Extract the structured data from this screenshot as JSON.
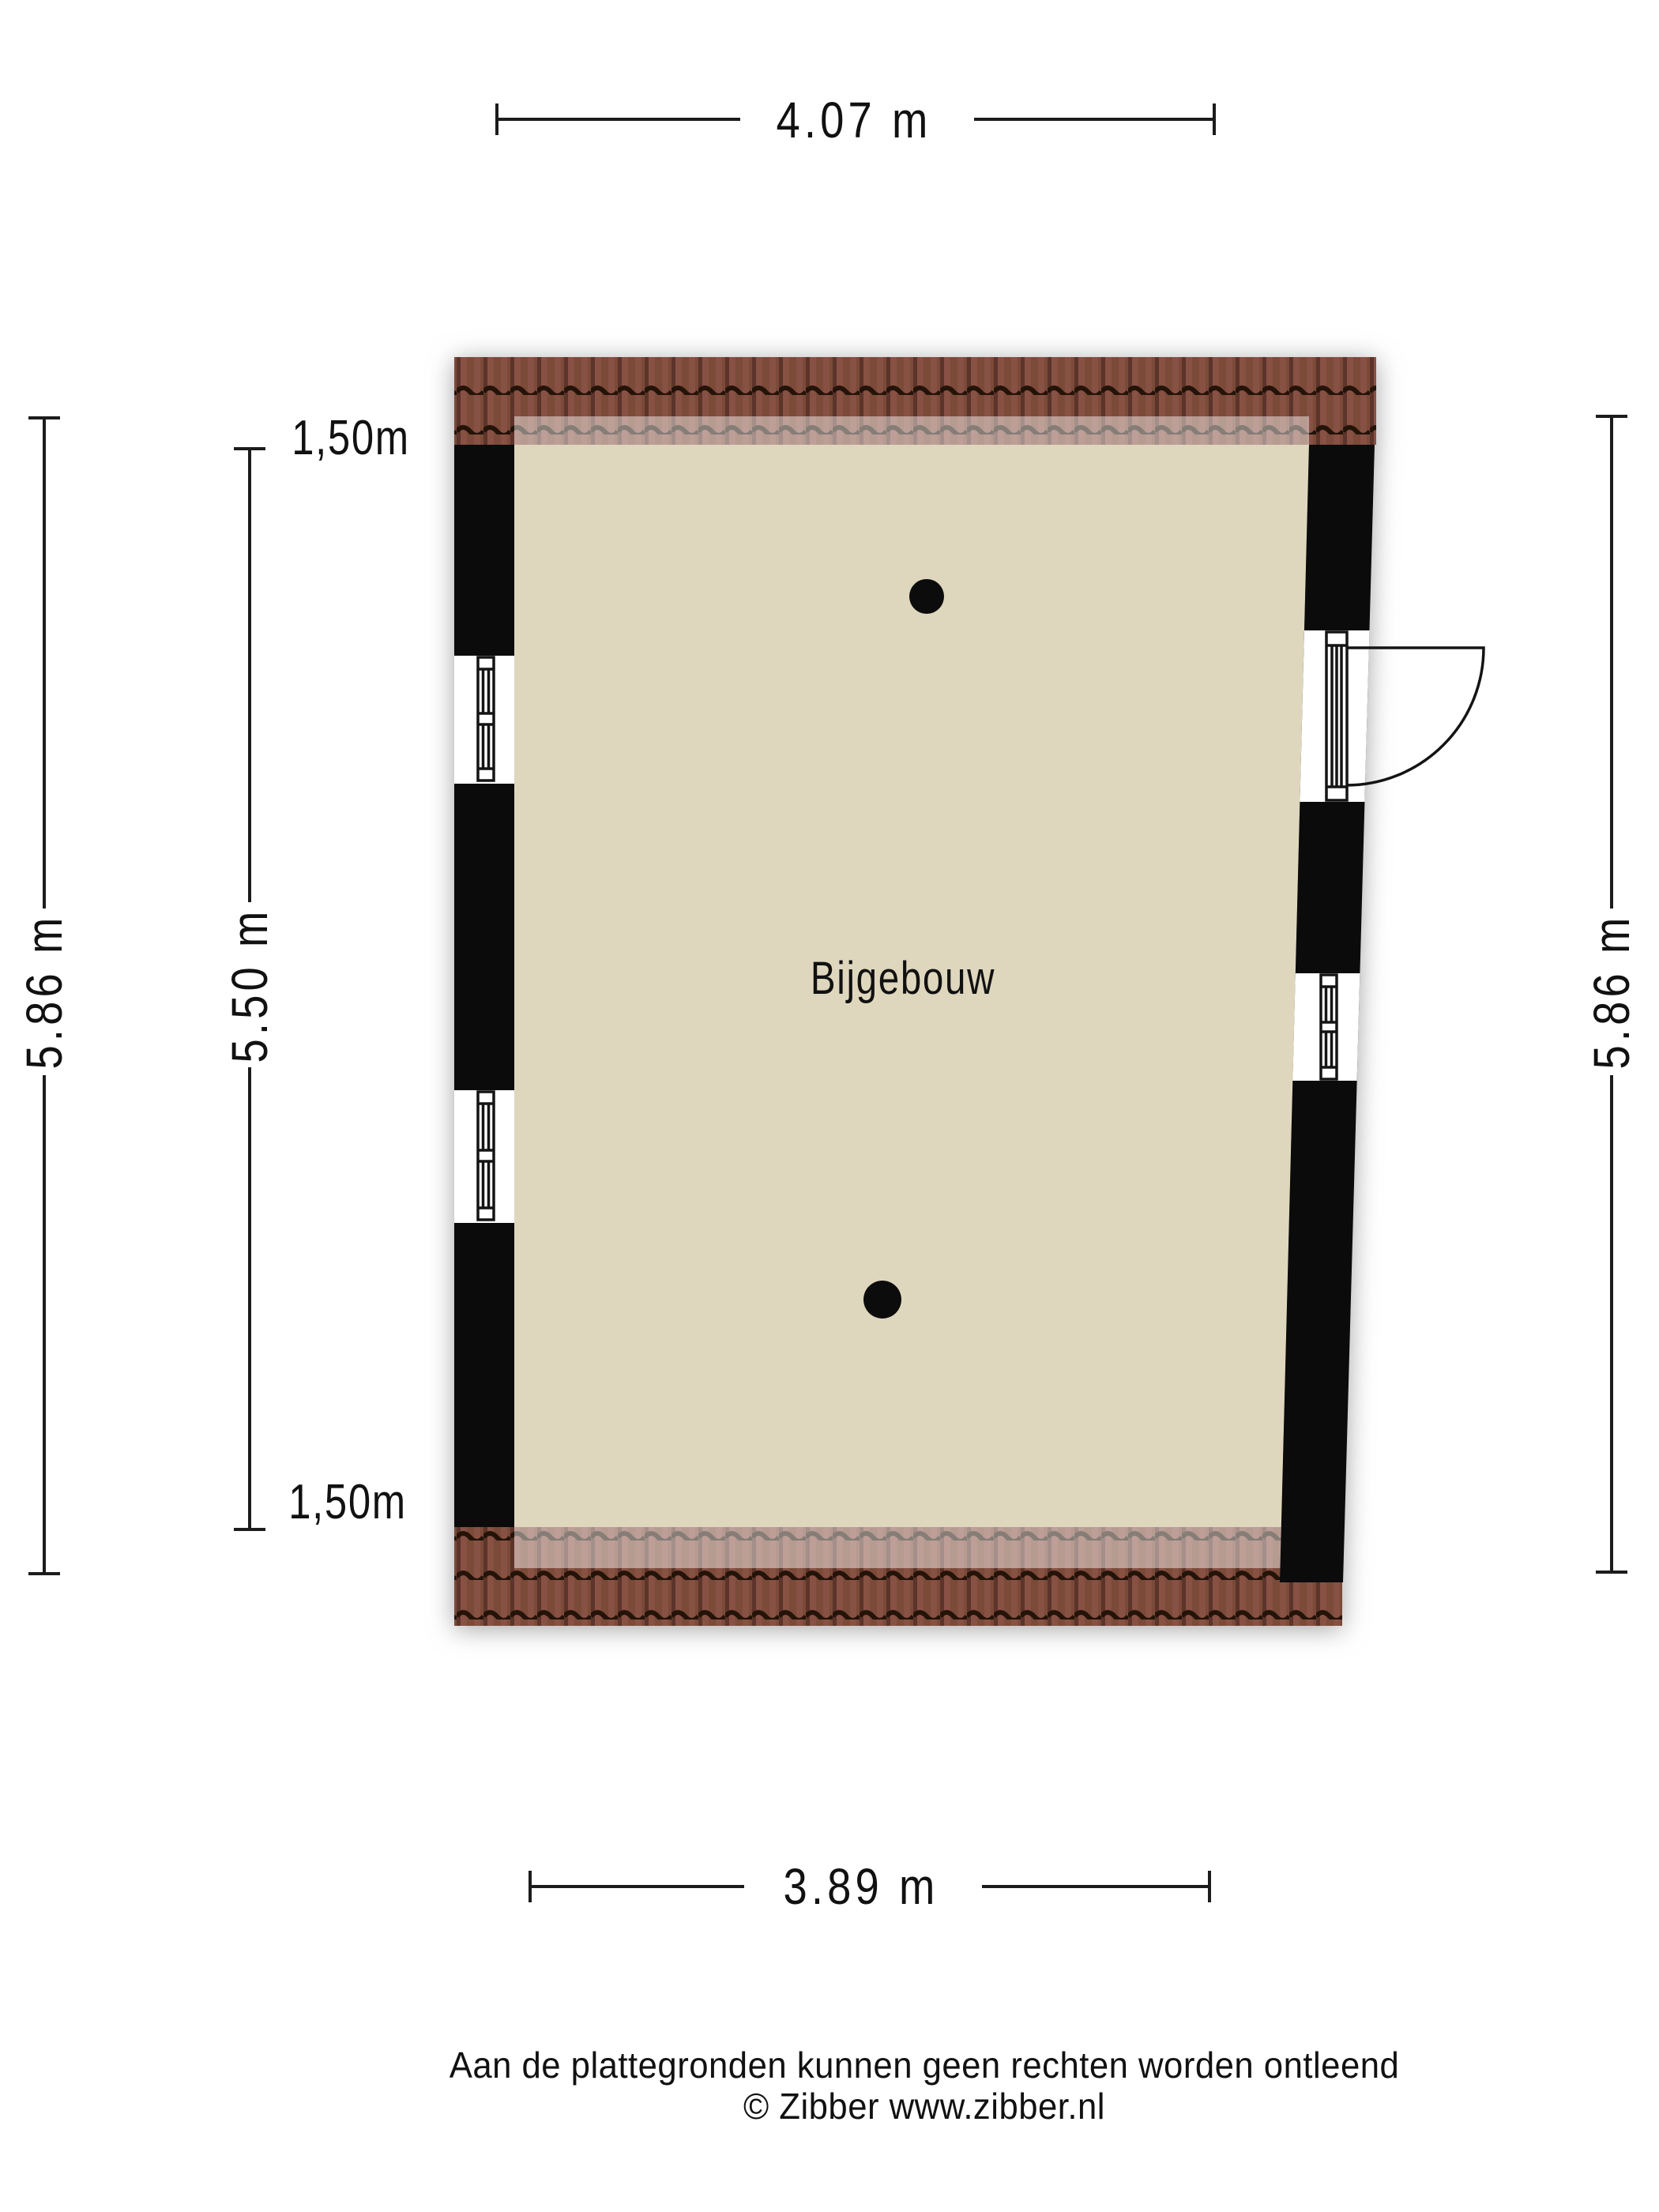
{
  "plan": {
    "room_label": "Bijgebouw"
  },
  "dimensions": {
    "top_width": "4.07 m",
    "bottom_width": "3.89 m",
    "left_outer_height": "5.86 m",
    "left_inner_height": "5.50 m",
    "right_height": "5.86 m",
    "left_top_offset": "1,50m",
    "left_bottom_offset": "1,50m"
  },
  "footer": {
    "disclaimer": "Aan de plattegronden kunnen geen rechten worden ontleend",
    "copyright": "© Zibber www.zibber.nl"
  },
  "colors": {
    "floor": "#ded7bd",
    "wall": "#0b0b0b",
    "roof_tile": "#7b4a38",
    "roof_tile_dark": "#5c342a",
    "roof_wave": "#241309",
    "dim_line": "#1c1c1c",
    "text": "#111111"
  }
}
